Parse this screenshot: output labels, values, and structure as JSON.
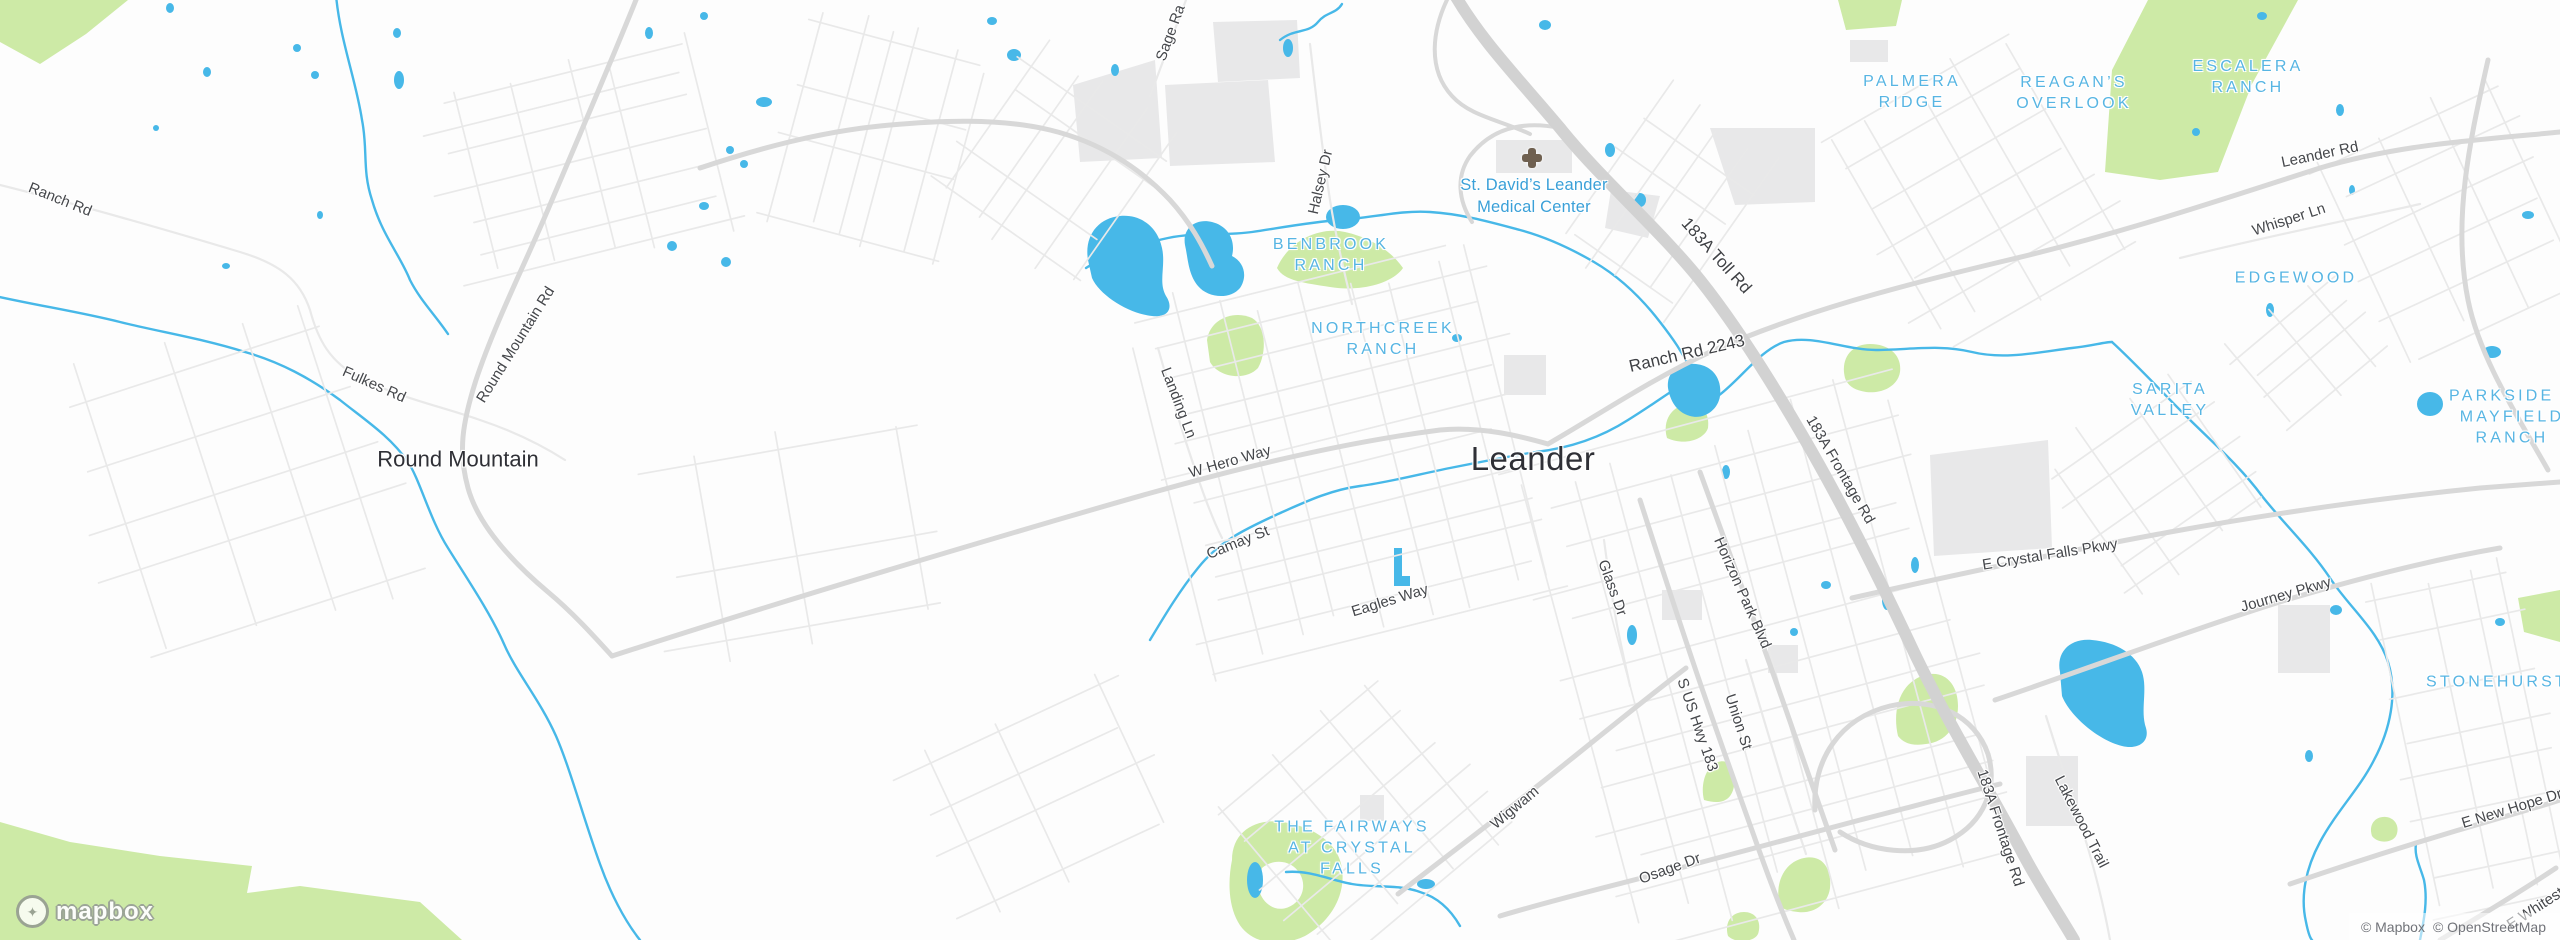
{
  "map": {
    "logo_text": "mapbox",
    "attribution": {
      "mapbox": "© Mapbox",
      "osm": "© OpenStreetMap"
    },
    "colors": {
      "water": "#47b8e8",
      "park": "#cdeaa6",
      "building": "#e8e8e9",
      "road-minor": "#e9e9e9",
      "road-med": "#d8d8d8",
      "road-hwy": "#d2d2d2",
      "city-label": "#2f3036",
      "neighborhood-label": "#57b5e3",
      "poi-label": "#3aa0d8",
      "road-label": "#45474b"
    },
    "labels": {
      "cities": [
        {
          "text": "Leander",
          "x": 1533,
          "y": 459,
          "rot": 0
        },
        {
          "text": "Round Mountain",
          "x": 458,
          "y": 459,
          "rot": 0,
          "small": true
        }
      ],
      "neighborhoods": [
        {
          "lines": [
            "BENBROOK",
            "RANCH"
          ],
          "x": 1331,
          "y": 255
        },
        {
          "lines": [
            "NORTHCREEK",
            "RANCH"
          ],
          "x": 1383,
          "y": 339
        },
        {
          "lines": [
            "PALMERA",
            "RIDGE"
          ],
          "x": 1912,
          "y": 92
        },
        {
          "lines": [
            "REAGAN’S",
            "OVERLOOK"
          ],
          "x": 2074,
          "y": 93
        },
        {
          "lines": [
            "ESCALERA",
            "RANCH"
          ],
          "x": 2248,
          "y": 77
        },
        {
          "lines": [
            "EDGEWOOD"
          ],
          "x": 2296,
          "y": 278
        },
        {
          "lines": [
            "SARITA",
            "VALLEY"
          ],
          "x": 2170,
          "y": 400
        },
        {
          "lines": [
            "PARKSIDE A",
            "MAYFIELD",
            "RANCH"
          ],
          "x": 2512,
          "y": 417
        },
        {
          "lines": [
            "STONEHURST"
          ],
          "x": 2497,
          "y": 682
        },
        {
          "lines": [
            "THE FAIRWAYS",
            "AT CRYSTAL",
            "FALLS"
          ],
          "x": 1352,
          "y": 848
        }
      ],
      "pois": [
        {
          "lines": [
            "St. David’s Leander",
            "Medical Center"
          ],
          "x": 1534,
          "y": 197,
          "icon": "hospital-cross-icon",
          "icon_x": 1532,
          "icon_y": 158
        }
      ],
      "roads": [
        {
          "text": "Ranch Rd",
          "x": 60,
          "y": 200,
          "rot": 22
        },
        {
          "text": "Fulkes Rd",
          "x": 374,
          "y": 385,
          "rot": 24
        },
        {
          "text": "Round Mountain Rd",
          "x": 516,
          "y": 345,
          "rot": -58
        },
        {
          "text": "Sage Ra",
          "x": 1171,
          "y": 33,
          "rot": -70
        },
        {
          "text": "Halsey Dr",
          "x": 1321,
          "y": 182,
          "rot": -77
        },
        {
          "text": "Landing Ln",
          "x": 1178,
          "y": 403,
          "rot": 69
        },
        {
          "text": "W Hero Way",
          "x": 1230,
          "y": 462,
          "rot": -16
        },
        {
          "text": "Camay St",
          "x": 1238,
          "y": 543,
          "rot": -22
        },
        {
          "text": "Eagles Way",
          "x": 1390,
          "y": 601,
          "rot": -17
        },
        {
          "text": "183A Toll Rd",
          "x": 1716,
          "y": 256,
          "rot": 48,
          "lg": true
        },
        {
          "text": "Ranch Rd 2243",
          "x": 1687,
          "y": 354,
          "rot": -13,
          "lg": true
        },
        {
          "text": "183A Frontage Rd",
          "x": 1840,
          "y": 470,
          "rot": 60
        },
        {
          "text": "Leander Rd",
          "x": 2320,
          "y": 155,
          "rot": -12
        },
        {
          "text": "Whisper Ln",
          "x": 2289,
          "y": 220,
          "rot": -18
        },
        {
          "text": "E Crystal Falls Pkwy",
          "x": 2050,
          "y": 555,
          "rot": -9
        },
        {
          "text": "Journey Pkwy",
          "x": 2286,
          "y": 595,
          "rot": -16
        },
        {
          "text": "Glass Dr",
          "x": 1612,
          "y": 588,
          "rot": 70
        },
        {
          "text": "Horizon Park Blvd",
          "x": 1742,
          "y": 593,
          "rot": 66
        },
        {
          "text": "S US Hwy 183",
          "x": 1697,
          "y": 725,
          "rot": 71
        },
        {
          "text": "Union St",
          "x": 1738,
          "y": 722,
          "rot": 72
        },
        {
          "text": "Wigwam",
          "x": 1515,
          "y": 808,
          "rot": -40
        },
        {
          "text": "Osage Dr",
          "x": 1670,
          "y": 869,
          "rot": -20
        },
        {
          "text": "Lakewood Trail",
          "x": 2081,
          "y": 822,
          "rot": 63
        },
        {
          "text": "183A Frontage Rd",
          "x": 2000,
          "y": 828,
          "rot": 72
        },
        {
          "text": "E New Hope Dr",
          "x": 2512,
          "y": 809,
          "rot": -17
        },
        {
          "text": "E Whitestone Blvd",
          "x": 2560,
          "y": 893,
          "rot": -33
        }
      ]
    }
  }
}
